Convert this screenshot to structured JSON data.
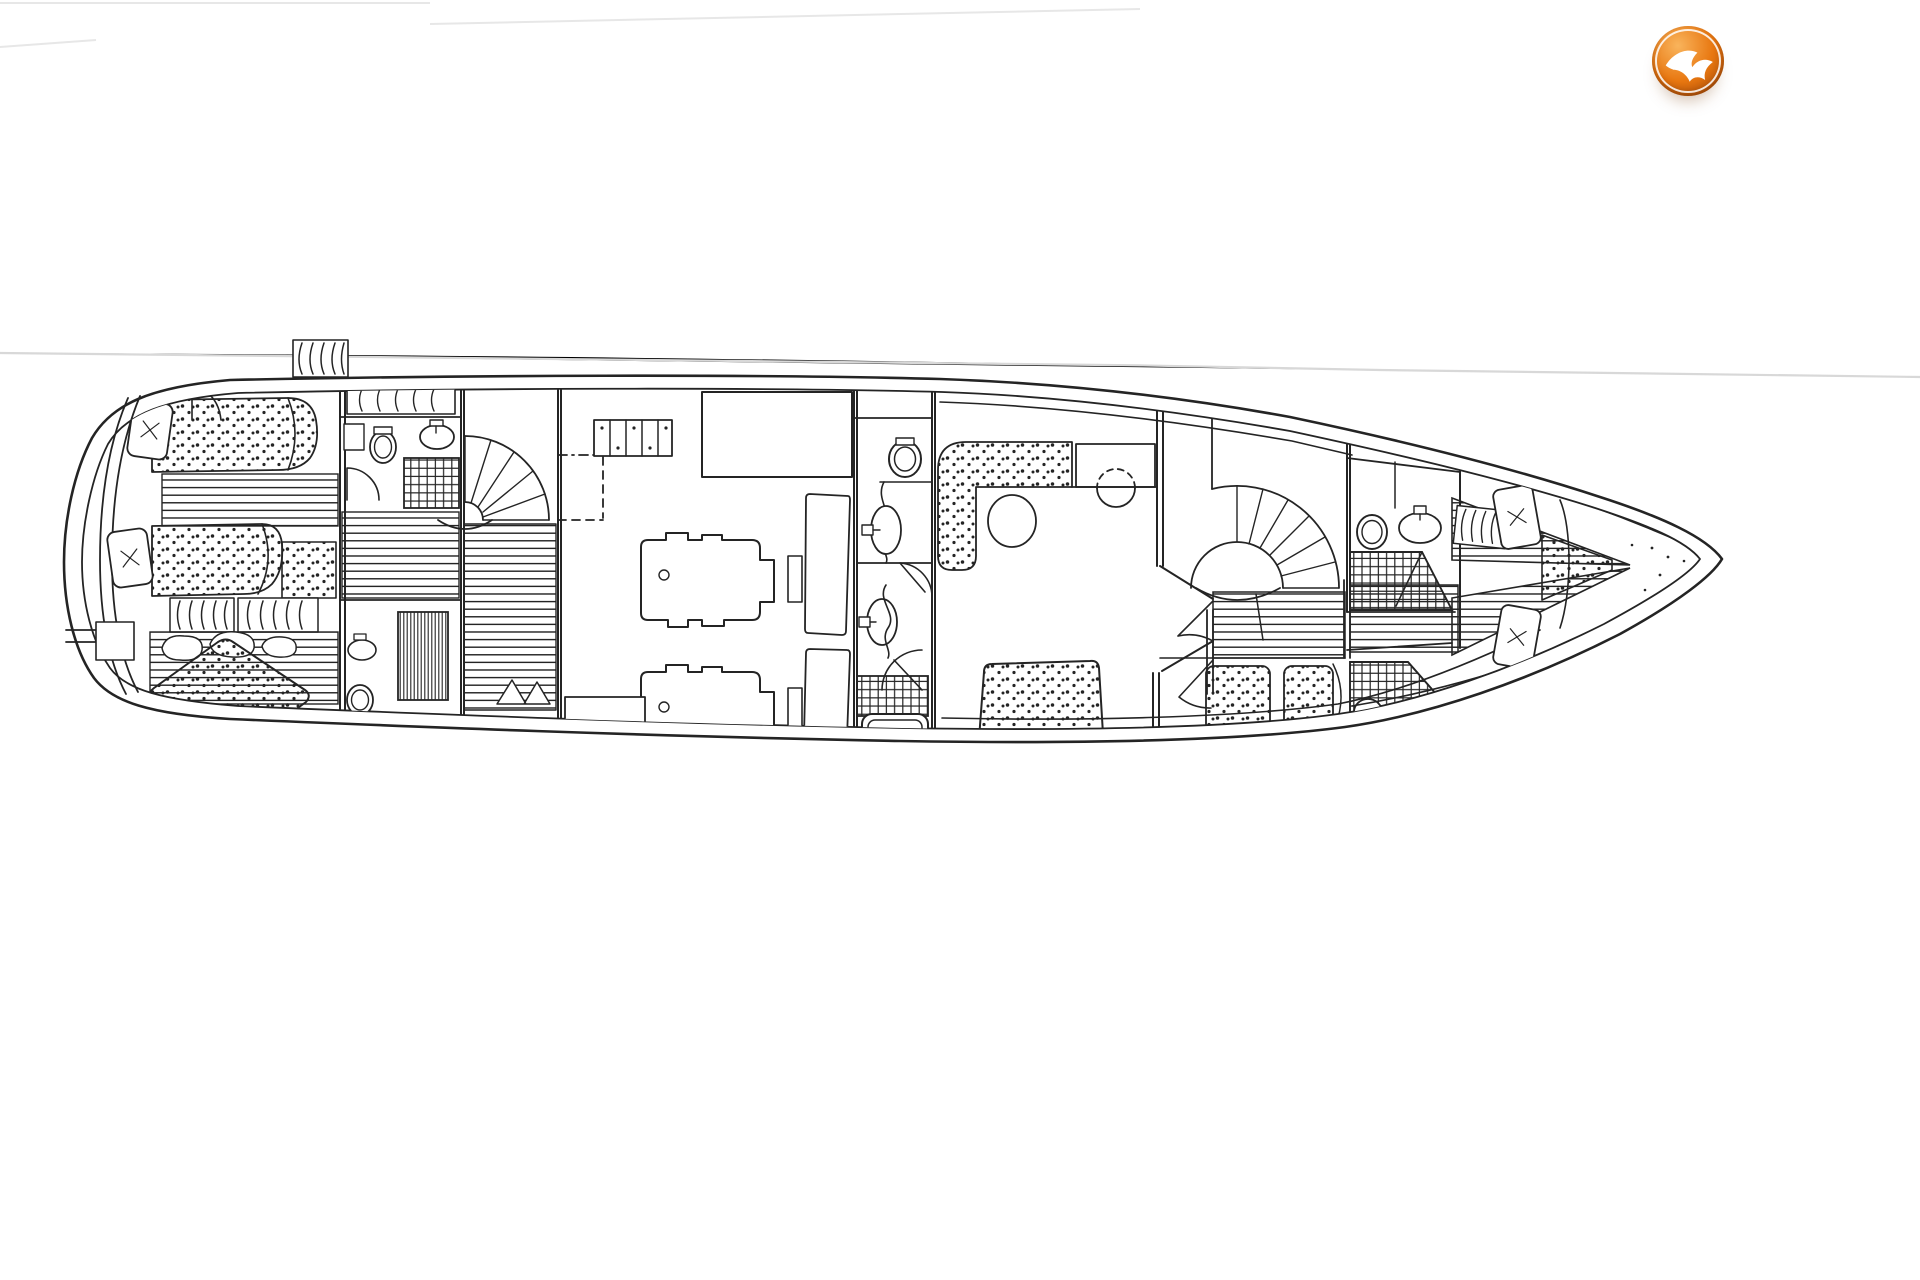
{
  "page": {
    "kind": "scanned yacht deck plan",
    "background": "#ffffff"
  },
  "colors": {
    "paper": "#ffffff",
    "ink": "#242424",
    "scan_line": "#d8d8d8",
    "scan_line_faint": "#e7e7e7",
    "logo_orange": "#e87710",
    "logo_orange_dark": "#a34708",
    "logo_orange_light": "#f9b45c",
    "logo_bird": "#ffffff"
  },
  "logo": {
    "icon": "seagull-icon",
    "shape": "glossy-orange-sphere"
  },
  "drawing": {
    "type": "motor-yacht lower deck floor plan, black ink line drawing",
    "features": [
      "hull-outline",
      "transom-steps",
      "aft-owners-cabin",
      "single-berth-port",
      "single-berth-aft",
      "double-berth-diagonal",
      "pillows",
      "deck-vent-louvres",
      "hanging-locker",
      "aft-bathroom",
      "toilet",
      "washbasin",
      "shower-grid",
      "quarter-turn-staircase",
      "engine-room",
      "battery-bank",
      "fuel-tank",
      "port-engine",
      "starboard-engine",
      "day-head-corridor",
      "bathtub",
      "dinette-sofa",
      "dinette-table",
      "bar-stool",
      "sideboard",
      "master-cabin",
      "double-berth-master",
      "spiral-staircase",
      "companionway-planking",
      "guest-cabin-twin-berths",
      "forward-bathroom-port",
      "forward-bathroom-starboard",
      "v-berth",
      "anchor-locker"
    ]
  }
}
